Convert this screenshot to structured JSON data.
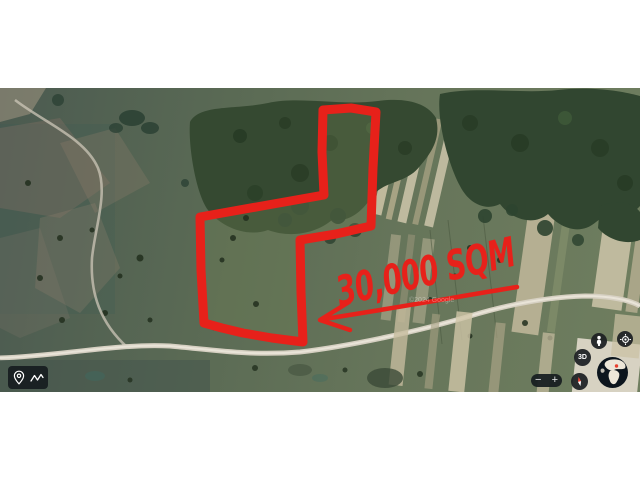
{
  "map": {
    "type_hint": "satellite-imagery",
    "watermark": "©2024 Google"
  },
  "annotation": {
    "area_label": "30,000 SQM",
    "shape": "hand-drawn parcel outline with left-pointing arrow",
    "color": "#e7211a"
  },
  "toolbar": {
    "buttons": [
      {
        "icon": "location-pin-icon"
      },
      {
        "icon": "draw-path-icon"
      }
    ]
  },
  "controls": {
    "street_view": {
      "icon": "pegman-icon"
    },
    "my_location": {
      "icon": "my-location-icon"
    },
    "view_3d": {
      "label": "3D"
    },
    "compass": {
      "icon": "compass-needle-icon"
    },
    "globe": {
      "icon": "earth-globe-icon"
    },
    "zoom": {
      "out_label": "−",
      "in_label": "+"
    }
  },
  "colors": {
    "page_bg": "#ffffff",
    "annotation_red": "#e7211a",
    "control_bg": "#1c1f22",
    "forest_green": "#344931",
    "field_green": "#66755a",
    "road_tan": "#d6d0c2"
  }
}
